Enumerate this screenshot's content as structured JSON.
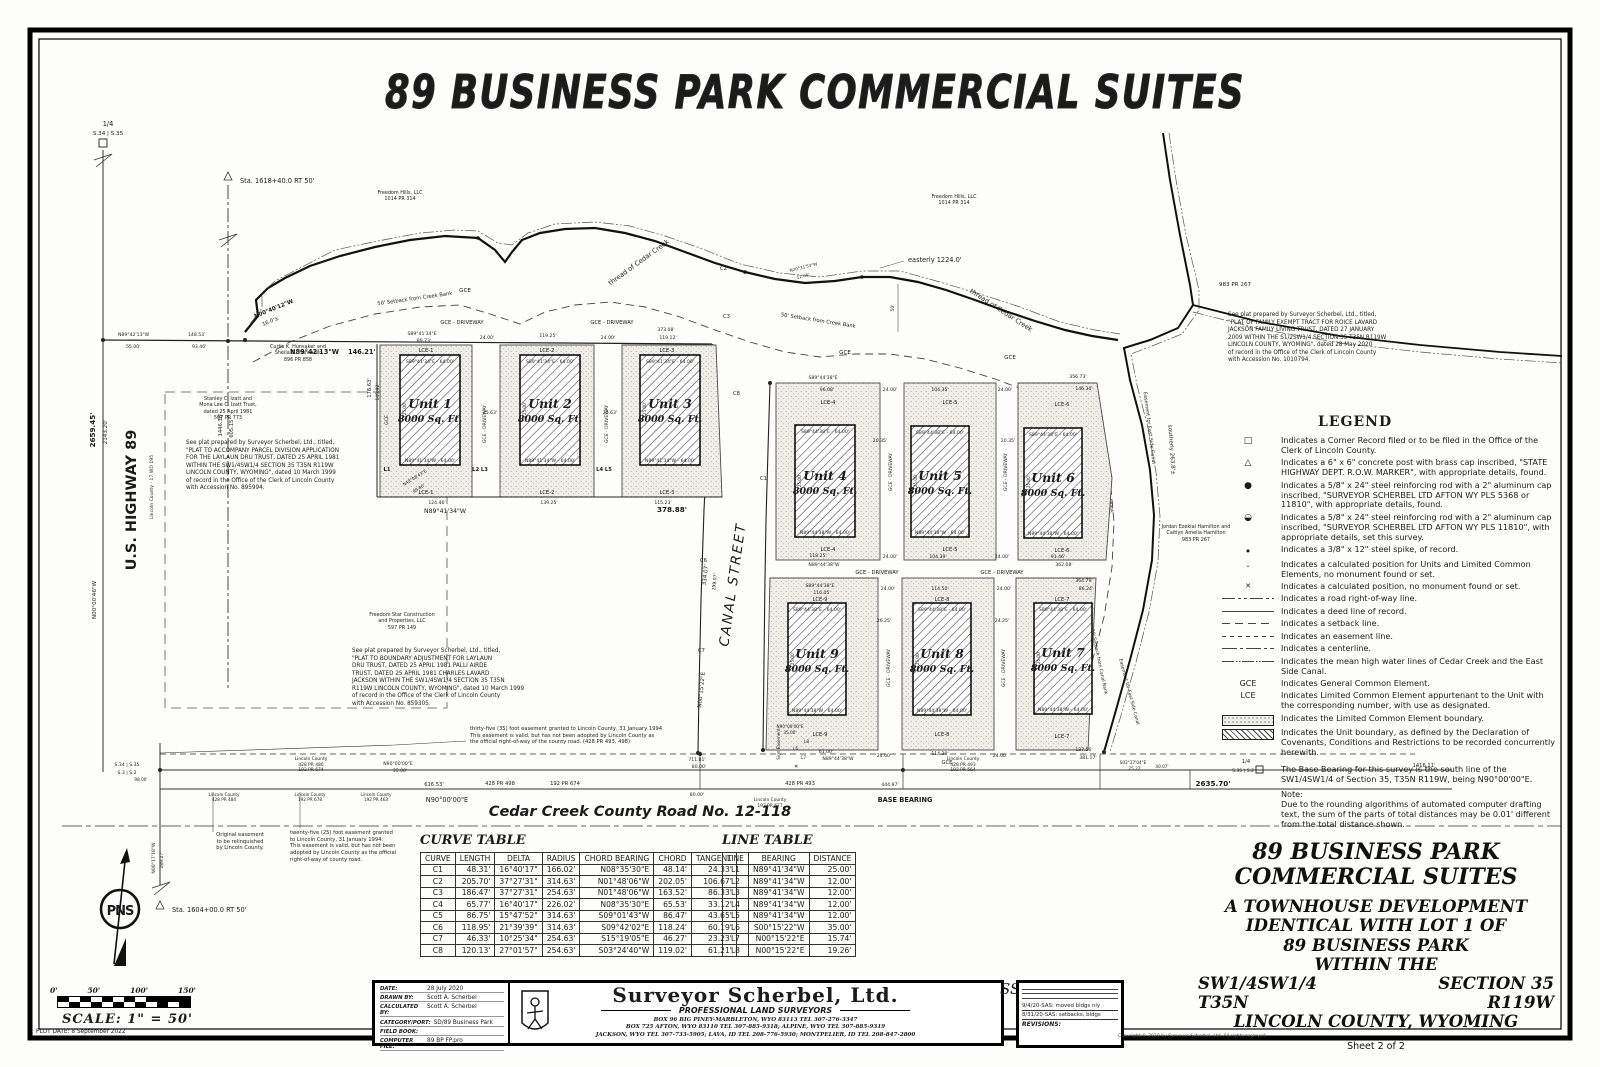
{
  "title": "89 BUSINESS PARK COMMERCIAL SUITES",
  "map": {
    "labels": {
      "quarter": "1/4",
      "sec_34_35": "S.34 | S.35",
      "sec_3_2": "S.3 | S.2",
      "sec_35_2": "S.35 | S.2",
      "sta_top": "Sta. 1618+40.0 RT 50'",
      "sta_bottom": "Sta. 1604+00.0 RT 50'",
      "d2659": "2659.45'",
      "d2143": "2143.20'",
      "d1446": "1446.38'",
      "d605": "605.15'",
      "highway": "U.S. HIGHWAY 89",
      "county_ref": "Lincoln County - 17 WD 195",
      "n000046": "N00°00'46\"W",
      "n001718": "N00°17'18\"W",
      "d28927": "289.27'",
      "n894213": "N89°42'13\"W",
      "d55": "55.00'",
      "d14853": "148.53'",
      "d9346": "93.46'",
      "d14621": "146.21'",
      "n004012": "N00°40'12\"W",
      "d16": "16.0'±",
      "creek": "thread of Cedar Creek",
      "easterly": "easterly 1224.0'",
      "setback_creek": "50' Setback from Creek Bank",
      "n203153": "N20°31'53\"W",
      "d1265": "12.65'",
      "d50": "50'",
      "gce": "GCE",
      "gce_driveway": "GCE - DRIVEWAY",
      "canal_street": "CANAL STREET",
      "d33407": "334.07'",
      "d29907": "299.07'",
      "n001522e": "N00°15'22\"E",
      "pr983": "983 PR 267",
      "esmt_canal": "Easement for East Side Canal",
      "southerly": "southerly 263.8'±",
      "setback_canal": "50' Setback from Canal Bank",
      "c1": "C1",
      "c2": "C2",
      "c3": "C3",
      "c4": "C4",
      "c5": "C5",
      "c6": "C6",
      "c7": "C7",
      "c8": "C8",
      "l1": "L1",
      "l23": "L2 L3",
      "l45": "L4 L5",
      "l6": "L6",
      "l7": "L7",
      "l8": "L8",
      "xmark": "✕",
      "n490843": "N49°08'43\"E",
      "d9980": "99.80'",
      "sign_easement": "Sign Easement",
      "n900000": "N90°00'00\"E",
      "d35": "35.00'",
      "d61653": "616.53'",
      "d71181": "711.81'",
      "d80": "80.00'",
      "road_name": "Cedar Creek County Road No. 12-118",
      "base_bearing": "BASE BEARING",
      "d44497": "444.97'",
      "d263570": "2635.70'",
      "d141611": "1416.11'",
      "s022704": "S02°27'04\"E",
      "d2522": "25.22'",
      "d4007": "40.07'",
      "d9800": "98.00'",
      "pr_428_498": "428 PR 498",
      "pr_192_674": "192 PR 674",
      "pr_428_493": "428 PR 493",
      "d17863": "178.63'",
      "d14592": "145.92'",
      "compass": "PNS"
    },
    "dims": {
      "d24": "24.00'",
      "d8973": "89.73'",
      "d11925": "119.25'",
      "d37308": "373.08'",
      "d11912": "119.12'",
      "d2563": "25.63'",
      "d12446": "124.46'",
      "d13925": "139.25'",
      "d11523": "115.23'",
      "n894134": "N89°41'34\"W",
      "d37888": "378.88'",
      "s894134": "S89°41'34\"E",
      "d9608": "96.08'",
      "d10435": "104.35'",
      "d35673": "356.73'",
      "d14630": "146.30'",
      "s894438": "S89°44'38\"E",
      "n894438": "N89°44'38\"W",
      "d11825": "118.25'",
      "d10439": "104.39'",
      "d9146": "91.46'",
      "d36208": "362.08'",
      "d11605": "116.05'",
      "d11450": "114.50'",
      "d36479": "364.79'",
      "d8624": "86.24'",
      "d2035": "20.35'",
      "d2625": "26.25'",
      "d2425": "24.25'",
      "d6100": "61.00'",
      "d11430": "114.30'",
      "d13756": "137.56'",
      "d38117": "381.17'",
      "d12500": "125.00'"
    },
    "units": [
      {
        "name": "Unit 1",
        "area": "8000 Sq. Ft.",
        "lce": "LCE-1",
        "top": "S89°41'34\"E - 64.00'",
        "bottom": "N89°41'34\"W - 64.00'"
      },
      {
        "name": "Unit 2",
        "area": "8000 Sq. Ft.",
        "lce": "LCE-2",
        "top": "S89°41'34\"E - 64.00'",
        "bottom": "N89°41'34\"W - 64.00'"
      },
      {
        "name": "Unit 3",
        "area": "8000 Sq. Ft.",
        "lce": "LCE-3",
        "top": "S89°41'34\"E - 64.00'",
        "bottom": "N89°41'34\"W - 64.00'"
      },
      {
        "name": "Unit 4",
        "area": "8000 Sq. Ft.",
        "lce": "LCE-4",
        "top": "S89°44'38\"E - 64.00'",
        "bottom": "N89°44'38\"W - 64.00'"
      },
      {
        "name": "Unit 5",
        "area": "8000 Sq. Ft.",
        "lce": "LCE-5",
        "top": "S89°44'38\"E - 64.00'",
        "bottom": "N89°44'38\"W - 64.00'"
      },
      {
        "name": "Unit 6",
        "area": "8000 Sq. Ft.",
        "lce": "LCE-6",
        "top": "S89°44'38\"E - 64.00'",
        "bottom": "N89°44'38\"W - 64.00'"
      },
      {
        "name": "Unit 7",
        "area": "8000 Sq. Ft.",
        "lce": "LCE-7",
        "top": "S89°44'38\"E - 64.00'",
        "bottom": "N89°44'38\"W - 64.00'"
      },
      {
        "name": "Unit 8",
        "area": "8000 Sq. Ft.",
        "lce": "LCE-8",
        "top": "S89°44'38\"E - 64.00'",
        "bottom": "N89°44'38\"W - 64.00'"
      },
      {
        "name": "Unit 9",
        "area": "8000 Sq. Ft.",
        "lce": "LCE-9",
        "top": "S89°44'38\"E - 64.00'",
        "bottom": "N89°44'38\"W - 64.00'"
      }
    ],
    "owners": {
      "freedom_hills": "Freedom Hills, LLC\n1014 PR 314",
      "hunsaker": "Curtis K. Hunsaker and\nSheila D. Hunsaker\n896 PR 858",
      "izatt": "Stanley C. Izatt and\nMona Lee C. Izatt Trust,\ndated 25 April 1981\n507 PR 773",
      "freedom_star": "Freedom Star Construction\nand Properties, LLC\n597 PR 149",
      "hamilton": "Jordan Ezekial Hamilton and\nCaitlyn Amelia Hamilton\n983 PR 267",
      "lc_486": "Lincoln County\n428 PR 486\n192 PR 674",
      "lc_493": "Lincoln County\n428 PR 493\n192 PR 564",
      "lc_677": "Lincoln County\n192 PR 677",
      "lc_484": "Lincoln County\n428 PR 484",
      "lc_678": "Lincoln County\n192 PR 678",
      "lc_463": "Lincoln County\n192 PR 463"
    },
    "notes": {
      "plat_a": "See plat prepared by Surveyor Scherbel, Ltd., titled,\n\"PLAT TO ACCOMPANY PARCEL DIVISION APPLICATION\nFOR THE LAYLAUN DRU TRUST, DATED 25 APRIL 1981\nWITHIN THE SW1/4SW1/4 SECTION 35 T35N R119W\nLINCOLN COUNTY, WYOMING\", dated 10 March 1999\nof record in the Office of the Clerk of Lincoln County\nwith Accession No. 895994.",
      "plat_b": "See plat prepared by Surveyor Scherbel, Ltd., titled,\n\"PLAT TO BOUNDARY ADJUSTMENT FOR LAYLAUN\nDRU TRUST, DATED 25 APRIL 1981 PALLI AIRDE\nTRUST, DATED 25 APRIL 1981 CHARLES LAVARD\nJACKSON WITHIN THE SW1/4SW1/4 SECTION 35 T35N\nR119W LINCOLN COUNTY, WYOMING\", dated 10 March 1999\nof record in the Office of the Clerk of Lincoln County\nwith Accession No. 859305.",
      "plat_c": "See plat prepared by Surveyor Scherbel, Ltd., titled,\n\"PLAT OF FAMILY EXEMPT TRACT FOR ROICE LAVARD\nJACKSON FAMILY LIVING TRUST, DATED 27 JANUARY\n2009 WITHIN THE S1/2SW1/4 SECTION 35 T35N R119W\nLINCOLN COUNTY, WYOMING\", dated 28 May 2020\nof record in the Office of the Clerk of Lincoln County\nwith Accession No. 1010794.",
      "esmt35": "thirty-five (35) foot easement granted to Lincoln County, 31 January 1994.\nThis easement is valid, but has not been adopted by Lincoln County as\nthe official right-of-way of the county road. (428 PR 493, 498)",
      "orig_esmt": "Original easement\nto be relinquished\nby Lincoln County.",
      "esmt25": "twenty-five (25) foot easement granted\nto Lincoln County, 31 January 1994.\nThis easement is valid, but has not been\nadopted by Lincoln County as the official\nright-of-way of county road."
    }
  },
  "legend": {
    "title": "LEGEND",
    "items": [
      {
        "sym": "□",
        "text": "Indicates a Corner Record filed or to be filed in the Office of the Clerk of Lincoln County."
      },
      {
        "sym": "△",
        "text": "Indicates a 6\" x 6\" concrete post with brass cap inscribed, \"STATE HIGHWAY DEPT. R.O.W. MARKER\", with appropriate details, found."
      },
      {
        "sym": "●",
        "text": "Indicates a 5/8\" x 24\" steel reinforcing rod with a 2\" aluminum cap inscribed, \"SURVEYOR SCHERBEL LTD AFTON WY PLS 5368 or 11810\", with appropriate details, found."
      },
      {
        "sym": "◒",
        "text": "Indicates a 5/8\" x 24\" steel reinforcing rod with a 2\" aluminum cap inscribed, \"SURVEYOR SCHERBEL LTD AFTON WY PLS 11810\", with appropriate details, set this survey."
      },
      {
        "sym": "•",
        "text": "Indicates a 3/8\" x 12\" steel spike, of record."
      },
      {
        "sym": "·",
        "text": "Indicates a calculated position for Units and Limited Common Elements, no monument found or set."
      },
      {
        "sym": "✕",
        "text": "Indicates a calculated position, no monument found or set."
      },
      {
        "sym": "",
        "text": "Indicates a road right-of-way line."
      },
      {
        "sym": "",
        "text": "Indicates a deed line of record."
      },
      {
        "sym": "",
        "text": "Indicates a setback line."
      },
      {
        "sym": "",
        "text": "Indicates an easement line."
      },
      {
        "sym": "",
        "text": "Indicates a centerline."
      },
      {
        "sym": "",
        "text": "Indicates the mean high water lines of Cedar Creek and the East Side Canal."
      },
      {
        "sym": "GCE",
        "text": "Indicates General Common Element."
      },
      {
        "sym": "LCE",
        "text": "Indicates Limited Common Element appurtenant to the Unit with the corresponding number, with use as designated."
      },
      {
        "sym": "",
        "text": "Indicates the Limited Common Element boundary."
      },
      {
        "sym": "",
        "text": "Indicates the Unit boundary, as defined by the Declaration of Covenants, Conditions and Restrictions to be recorded concurrently herewith."
      }
    ],
    "base_bearing": "The Base Bearing for this survey is the south line of the SW1/4SW1/4 of Section 35, T35N R119W, being N90°00'00\"E.",
    "note_title": "Note:",
    "note_text": "Due to the rounding algorithms of automated computer drafting text, the sum of the parts of total distances may be 0.01' different from the total distance shown."
  },
  "curve_table": {
    "title": "CURVE TABLE",
    "headers": [
      "CURVE",
      "LENGTH",
      "DELTA",
      "RADIUS",
      "CHORD BEARING",
      "CHORD",
      "TANGENT"
    ],
    "rows": [
      [
        "C1",
        "48.31'",
        "16°40'17\"",
        "166.02'",
        "N08°35'30\"E",
        "48.14'",
        "24.33'"
      ],
      [
        "C2",
        "205.70'",
        "37°27'31\"",
        "314.63'",
        "N01°48'06\"W",
        "202.05'",
        "106.67'"
      ],
      [
        "C3",
        "186.47'",
        "37°27'31\"",
        "254.63'",
        "N01°48'06\"W",
        "163.52'",
        "86.33'"
      ],
      [
        "C4",
        "65.77'",
        "16°40'17\"",
        "226.02'",
        "N08°35'30\"E",
        "65.53'",
        "33.12'"
      ],
      [
        "C5",
        "86.75'",
        "15°47'52\"",
        "314.63'",
        "S09°01'43\"W",
        "86.47'",
        "43.65'"
      ],
      [
        "C6",
        "118.95'",
        "21°39'39\"",
        "314.63'",
        "S09°42'02\"E",
        "118.24'",
        "60.19'"
      ],
      [
        "C7",
        "46.33'",
        "10°25'34\"",
        "254.63'",
        "S15°19'05\"E",
        "46.27'",
        "23.23'"
      ],
      [
        "C8",
        "120.13'",
        "27°01'57\"",
        "254.63'",
        "S03°24'40\"W",
        "119.02'",
        "61.21'"
      ]
    ]
  },
  "line_table": {
    "title": "LINE TABLE",
    "headers": [
      "LINE",
      "BEARING",
      "DISTANCE"
    ],
    "rows": [
      [
        "L1",
        "N89°41'34\"W",
        "25.00'"
      ],
      [
        "L2",
        "N89°41'34\"W",
        "12.00'"
      ],
      [
        "L3",
        "N89°41'34\"W",
        "12.00'"
      ],
      [
        "L4",
        "N89°41'34\"W",
        "12.00'"
      ],
      [
        "L5",
        "N89°41'34\"W",
        "12.00'"
      ],
      [
        "L6",
        "S00°15'22\"W",
        "35.00'"
      ],
      [
        "L7",
        "N00°15'22\"E",
        "15.74'"
      ],
      [
        "L8",
        "N00°15'22\"E",
        "19.26'"
      ]
    ]
  },
  "sheet_block": {
    "l1": "89 BUSINESS PARK",
    "l2": "COMMERCIAL SUITES",
    "l3": "A TOWNHOUSE DEVELOPMENT",
    "l4": "IDENTICAL WITH LOT 1 OF",
    "l5": "89 BUSINESS PARK",
    "l6": "WITHIN THE",
    "sw": "SW1/4SW1/4",
    "sec": "SECTION 35",
    "twp": "T35N",
    "rng": "R119W",
    "county": "LINCOLN COUNTY, WYOMING",
    "sheet": "Sheet 2 of 2"
  },
  "title_block": {
    "fields": [
      {
        "label": "DATE:",
        "value": "28 July 2020"
      },
      {
        "label": "DRAWN BY:",
        "value": "Scott A. Scherbel"
      },
      {
        "label": "CALCULATED BY:",
        "value": "Scott A. Scherbel"
      },
      {
        "label": "CATEGORY/PORT:",
        "value": "SD/89 Business Park"
      },
      {
        "label": "FIELD BOOK:",
        "value": ""
      },
      {
        "label": "COMPUTER FILE:",
        "value": "89 BP FP.pro"
      }
    ],
    "company": "Surveyor Scherbel, Ltd.",
    "subtitle": "PROFESSIONAL LAND SURVEYORS",
    "addresses": [
      "BOX 96 BIG PINEY-MARBLETON, WYO 83113 TEL 307-276-3347",
      "BOX 725 AFTON, WYO 83110 TEL 307-885-9318; ALPINE, WYO TEL 307-885-9319",
      "JACKSON, WYO TEL 307-733-5905; LAVA, ID TEL 208-776-5930; MONTPELIER, ID TEL 208-847-2800"
    ],
    "monogram": "SS",
    "revisions_label": "REVISIONS:",
    "revisions": [
      "9/4/20-SAS: moved bldgs nly",
      "8/31/20-SAS: setbacks, bldgs"
    ],
    "copyright": "Copyright © 2020 by Surveyor Scherbel, Ltd.  All rights reserved."
  },
  "scale_bar": {
    "ticks": [
      "0'",
      "50'",
      "100'",
      "150'"
    ],
    "label": "SCALE:  1\" = 50'"
  },
  "plot_date": "PLOT DATE: 8 September 2022"
}
